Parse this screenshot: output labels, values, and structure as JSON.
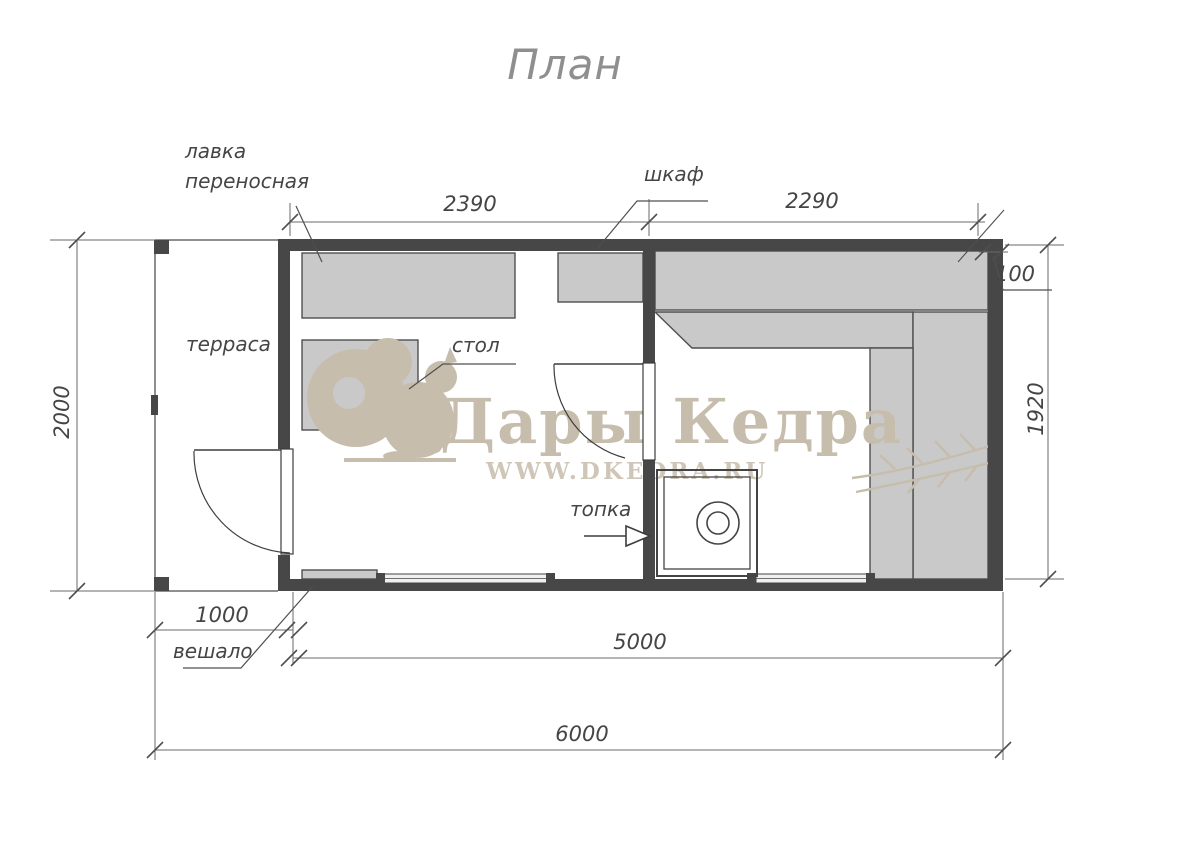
{
  "title": "План",
  "watermark": {
    "brand": "Дары Кедра",
    "site": "WWW.DKEDRA.RU",
    "color": "#c7bdad"
  },
  "labels": {
    "bench_line1": "лавка",
    "bench_line2": "переносная",
    "cabinet": "шкаф",
    "terrace": "терраса",
    "table": "стол",
    "firebox": "топка",
    "hanger": "вешало"
  },
  "dimensions": {
    "room_left_width": "2390",
    "room_right_width": "2290",
    "wall_thickness": "100",
    "total_depth": "2000",
    "interior_depth": "1920",
    "terrace_width": "1000",
    "building_width": "5000",
    "total_width": "6000"
  },
  "colors": {
    "wall": "#474747",
    "furniture": "#c9c9c9",
    "line": "#555555",
    "watermark": "#c7bdad"
  }
}
